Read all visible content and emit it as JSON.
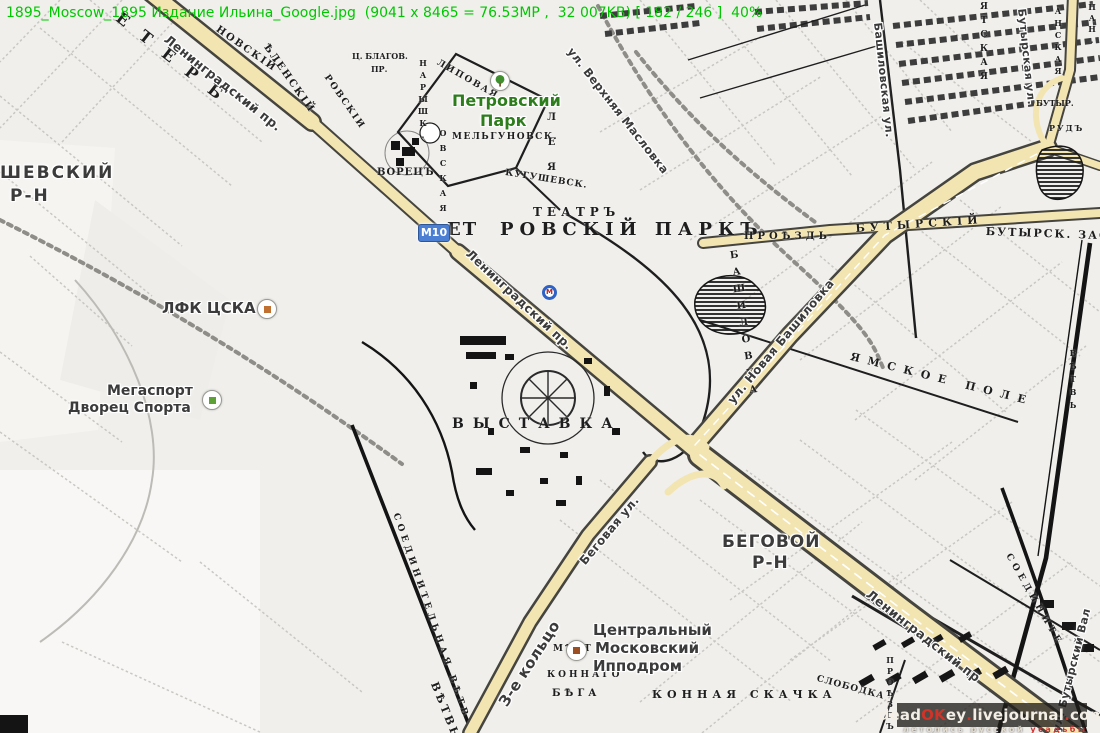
{
  "viewer": {
    "title": "1895_Moscow_1895 Издание Ильина_Google.jpg  (9041 x 8465 = 76.53MP ,  32 007KB) [ 182 / 246 ]  40%"
  },
  "overlay": {
    "m10": "М10",
    "metro_letter": "М",
    "districts": {
      "left_l1": "ШЕВСКИЙ",
      "left_l2": "Р-Н",
      "begovoy_l1": "БЕГОВОЙ",
      "begovoy_l2": "Р-Н"
    },
    "pois": {
      "petrovsky_l1": "Петровский",
      "petrovsky_l2": "Парк",
      "lfk": "ЛФК ЦСКА",
      "megasport_l1": "Мегаспорт",
      "megasport_l2": "Дворец Спорта",
      "hippo_l1": "Центральный",
      "hippo_l2": "Московский",
      "hippo_l3": "Ипподром"
    },
    "streets": {
      "leningradsky_nw": "Ленинградский пр.",
      "leningradsky_mid": "Ленинградский пр.",
      "leningradsky_se": "Ленинградский пр",
      "maslovka": "ул. Верхняя Масловка",
      "novaya_bashilovka": "ул. Новая Башиловка",
      "begovaya": "Беговая ул.",
      "bashilovskaya": "Башиловская ул.",
      "butyrskaya": "Бутырская ул.",
      "butyrsky_val": "ул. Бутырский Вал",
      "third_ring": "З-е кольцо"
    }
  },
  "old_map": {
    "et": "ЕТ",
    "rovskiy_park": "РОВСКІЙ ПАРКЪ",
    "teatr": "ТЕАТРЪ",
    "melgunovsk": "МЕЛЬГУНОВСК.",
    "kugushevsk": "КУГУШЕВСК.",
    "vystavka": "ВЫСТАВКА",
    "vorets": "ВОРЕЦЪ",
    "blagov": "Ц. БЛАГОВ.",
    "pr": "ПР.",
    "novskiy": "НОВСКІЙ",
    "yelenskiy": "ѢЛЕНСКІЙ",
    "rovskii2": "РОВСКІИ",
    "naryshk": "НАРЫШК.",
    "lipovaya": "ЛИПОВАЯ",
    "ovskaya": "ОВСКАЯ",
    "alleya": "ЛЕЯ",
    "peterb": "ЕТЕРБ",
    "yamskoe": "ЯМСКОЕ ПОЛЕ",
    "proezd": "ПРОѢЗДЬ",
    "butyrskiy": "БУТЫРСКІЙ",
    "butyrsk_zast": "БУТЫРСК. ЗАСТ.",
    "butyr": "БУТЫР.",
    "prud": "РУДЪ",
    "anskaya": "АНСКАЯ",
    "pan": "ПАН.",
    "yatskaya": "ЯТСКАЯ",
    "bashilovka": "БАШИЛОВКА",
    "konnaya_skachka": "КОННАЯ СКАЧКА",
    "mest": "МѢСТ",
    "konnago": "КОННАГО",
    "bega": "БѢГА",
    "slobodka": "СЛОБОДКА",
    "proezd2": "ПРОѢЗДЪ",
    "soedinit_left": "СОЕДИНИТЕЛЬНАЯ ВѢТВ",
    "soedinit_right": "СОЕДИНИТЕ",
    "vetv1": "ВѢТВЬ",
    "vetv2": "ВѢТВЬ"
  },
  "watermark": {
    "p1": "dead",
    "p2": "OK",
    "p3": "ey",
    "p4": ".",
    "p5": "livejournal",
    "p6": ".",
    "p7": "com",
    "sub1": "летопись русской",
    "sub2": " усадьбы"
  }
}
